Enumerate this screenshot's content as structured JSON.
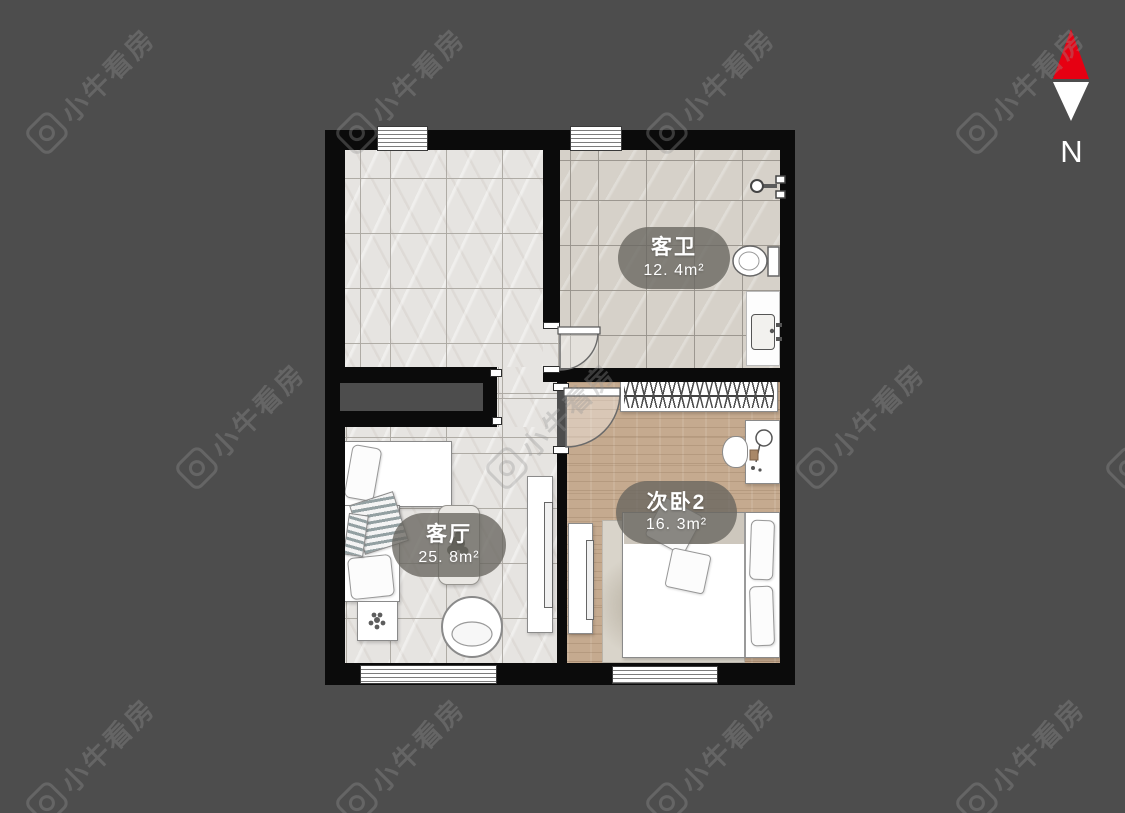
{
  "canvas": {
    "background_color": "#4d4d4d",
    "wall_color": "#0b0b0b"
  },
  "watermark": {
    "text": "小牛看房",
    "logo": "niu-camera-logo"
  },
  "compass": {
    "label": "N",
    "arrow_top_color": "#e60012",
    "arrow_bottom_color": "#ffffff"
  },
  "floor_plan": {
    "rooms": [
      {
        "key": "guest-bathroom",
        "name": "客卫",
        "area": "12. 4m²"
      },
      {
        "key": "living-room",
        "name": "客厅",
        "area": "25. 8m²"
      },
      {
        "key": "bedroom-2",
        "name": "次卧2",
        "area": "16. 3m²"
      }
    ],
    "label_pill_color": "#68655f",
    "tile_floor_color": "#e6e4e1",
    "bath_floor_color": "#d6d1c9",
    "wood_floor_color": "#c5aa8f"
  }
}
